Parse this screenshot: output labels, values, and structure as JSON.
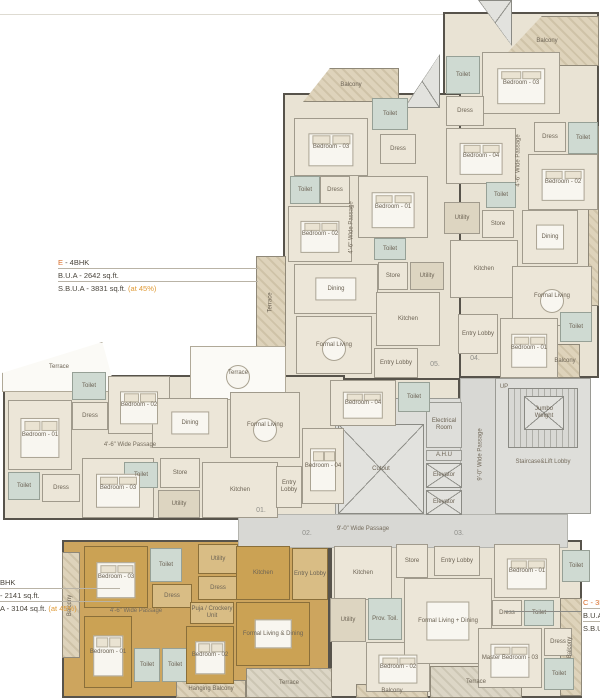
{
  "palette": {
    "unit_fill": "#e9e3d4",
    "highlight_unit_fill": "#cda55e",
    "toilet_fill": "#cfdad2",
    "passage_fill": "#d8d8d4",
    "wall": "#57534b",
    "annotation_accent": "#d96e2a",
    "annotation_highlight": "#e09a35"
  },
  "annotations": {
    "e": {
      "code": "E ",
      "type": "- 4BHK",
      "bua": "B.U.A - 2642 sq.ft.",
      "sbua": "S.B.U.A - 3831 sq.ft.",
      "at": "(at 45%)"
    },
    "a": {
      "type": "BHK",
      "bua": "- 2141 sq.ft.",
      "sbua": "A - 3104 sq.ft.",
      "at": "(at 45%)"
    },
    "c": {
      "code": "C - 3B",
      "bua": "B.U.A - ",
      "sbua": "S.B.U.A"
    }
  },
  "entry_numbers": [
    "01.",
    "02.",
    "03.",
    "04.",
    "05."
  ],
  "rooms": [
    {
      "t": "u-beige",
      "nm": "unit-d-outline",
      "x": 443,
      "y": 12,
      "w": 156,
      "h": 366
    },
    {
      "t": "u-beige",
      "nm": "unit-e-outline",
      "x": 283,
      "y": 93,
      "w": 178,
      "h": 288
    },
    {
      "t": "u-beige",
      "nm": "unit-e-extension",
      "x": 328,
      "y": 378,
      "w": 132,
      "h": 48
    },
    {
      "t": "u-beige",
      "nm": "unit-01-outline",
      "x": 3,
      "y": 375,
      "w": 342,
      "h": 145
    },
    {
      "t": "u-orange",
      "nm": "unit-a-outline",
      "x": 62,
      "y": 540,
      "w": 268,
      "h": 158
    },
    {
      "t": "u-beige",
      "nm": "unit-c-outline",
      "x": 330,
      "y": 540,
      "w": 252,
      "h": 158
    },
    {
      "t": "core",
      "nm": "core-block",
      "x": 335,
      "y": 398,
      "w": 130,
      "h": 118
    },
    {
      "t": "pas",
      "nm": "vertical-passage",
      "x": 460,
      "y": 378,
      "w": 42,
      "h": 138
    },
    {
      "t": "pas",
      "nm": "horizontal-passage",
      "x": 238,
      "y": 514,
      "w": 330,
      "h": 34
    },
    {
      "t": "core",
      "nm": "staircase-block",
      "x": 495,
      "y": 378,
      "w": 96,
      "h": 136
    },
    {
      "t": "xbox",
      "nm": "corner-brace",
      "x": 478,
      "y": 0,
      "w": 34,
      "h": 46,
      "c": "polygon(0 0,100% 0,100% 100%)"
    },
    {
      "t": "bal",
      "l": "Balcony",
      "x": 495,
      "y": 16,
      "w": 104,
      "h": 50,
      "c": "polygon(0 100%,45% 0,100% 0,100% 100%)"
    },
    {
      "t": "bal",
      "l": "Balcony",
      "x": 303,
      "y": 68,
      "w": 96,
      "h": 34,
      "c": "polygon(0 100%,28% 0,100% 0,100% 100%)"
    },
    {
      "t": "xbox",
      "nm": "corner-brace-2",
      "x": 404,
      "y": 54,
      "w": 36,
      "h": 54,
      "c": "polygon(100% 0,100% 100%,0 100%)"
    },
    {
      "t": "bal",
      "l": "Terrace",
      "r": 1,
      "x": 256,
      "y": 256,
      "w": 30,
      "h": 92
    },
    {
      "t": "ter",
      "l": "Terrace",
      "x": 190,
      "y": 346,
      "w": 96,
      "h": 54,
      "f": "round"
    },
    {
      "t": "ter",
      "l": "Terrace",
      "x": 2,
      "y": 342,
      "w": 114,
      "h": 50,
      "c": "polygon(0 62%,88% 0,100% 100%,0 100%)"
    },
    {
      "t": "bal",
      "l": "Balcony",
      "r": 1,
      "x": 62,
      "y": 552,
      "w": 18,
      "h": 106
    },
    {
      "t": "bal",
      "l": "Hanging Balcony",
      "x": 176,
      "y": 680,
      "w": 70,
      "h": 18
    },
    {
      "t": "balg",
      "l": "Terrace",
      "x": 246,
      "y": 668,
      "w": 86,
      "h": 30
    },
    {
      "t": "balg",
      "l": "Terrace",
      "x": 430,
      "y": 666,
      "w": 92,
      "h": 32
    },
    {
      "t": "bal",
      "l": "Balcony",
      "x": 356,
      "y": 684,
      "w": 72,
      "h": 14
    },
    {
      "t": "bal",
      "l": "Balcony",
      "r": 1,
      "x": 560,
      "y": 598,
      "w": 22,
      "h": 98
    },
    {
      "t": "bal",
      "nm": "balcony-strip-right",
      "x": 588,
      "y": 126,
      "w": 11,
      "h": 180
    },
    {
      "t": "bal",
      "l": "Balcony",
      "x": 550,
      "y": 344,
      "w": 30,
      "h": 34
    },
    {
      "t": "core",
      "l": "Electrical Room",
      "x": 426,
      "y": 402,
      "w": 36,
      "h": 46
    },
    {
      "t": "core",
      "l": "A.H.U",
      "x": 426,
      "y": 450,
      "w": 36,
      "h": 11
    },
    {
      "t": "xbox",
      "l": "Elevator",
      "x": 426,
      "y": 463,
      "w": 36,
      "h": 25
    },
    {
      "t": "xbox",
      "l": "Elevator",
      "x": 426,
      "y": 490,
      "w": 36,
      "h": 25
    },
    {
      "t": "xbox",
      "l": "Cutout",
      "x": 338,
      "y": 424,
      "w": 86,
      "h": 90
    },
    {
      "t": "stair",
      "nm": "staircase-treads",
      "x": 508,
      "y": 388,
      "w": 70,
      "h": 60
    },
    {
      "t": "xbox",
      "l": "Jumbo Weight",
      "x": 524,
      "y": 396,
      "w": 40,
      "h": 34
    },
    {
      "t": "pl",
      "l": "UP",
      "x": 496,
      "y": 382,
      "w": 16,
      "h": 10
    },
    {
      "t": "pl",
      "l": "Staircase&Lift Lobby",
      "x": 497,
      "y": 456,
      "w": 92,
      "h": 12
    },
    {
      "t": "toi",
      "l": "Toilet",
      "x": 446,
      "y": 56,
      "w": 34,
      "h": 38
    },
    {
      "t": "room",
      "l": "Bedroom - 03",
      "x": 482,
      "y": 52,
      "w": 78,
      "h": 62,
      "f": "bed"
    },
    {
      "t": "room",
      "l": "Dress",
      "x": 446,
      "y": 96,
      "w": 38,
      "h": 30
    },
    {
      "t": "room",
      "l": "Bedroom - 04",
      "x": 446,
      "y": 128,
      "w": 70,
      "h": 56,
      "f": "bed"
    },
    {
      "t": "room",
      "l": "Dress",
      "x": 534,
      "y": 122,
      "w": 32,
      "h": 30
    },
    {
      "t": "toi",
      "l": "Toilet",
      "x": 568,
      "y": 122,
      "w": 30,
      "h": 32
    },
    {
      "t": "room",
      "l": "Bedroom - 02",
      "x": 528,
      "y": 154,
      "w": 70,
      "h": 56,
      "f": "bed"
    },
    {
      "t": "toi",
      "l": "Toilet",
      "x": 486,
      "y": 182,
      "w": 30,
      "h": 26
    },
    {
      "t": "dark",
      "l": "Utility",
      "x": 444,
      "y": 202,
      "w": 36,
      "h": 32
    },
    {
      "t": "room",
      "l": "Store",
      "x": 482,
      "y": 210,
      "w": 32,
      "h": 28
    },
    {
      "t": "room",
      "l": "Kitchen",
      "x": 450,
      "y": 240,
      "w": 68,
      "h": 58
    },
    {
      "t": "room",
      "l": "Dining",
      "x": 522,
      "y": 210,
      "w": 56,
      "h": 54,
      "f": "table"
    },
    {
      "t": "room",
      "l": "Formal Living",
      "x": 512,
      "y": 266,
      "w": 80,
      "h": 60,
      "f": "round"
    },
    {
      "t": "room",
      "l": "Entry Lobby",
      "x": 458,
      "y": 314,
      "w": 40,
      "h": 40
    },
    {
      "t": "room",
      "l": "Bedroom - 01",
      "x": 500,
      "y": 318,
      "w": 58,
      "h": 60,
      "f": "bed"
    },
    {
      "t": "toi",
      "l": "Toilet",
      "x": 560,
      "y": 312,
      "w": 32,
      "h": 30
    },
    {
      "t": "pl",
      "l": "4'-6\" Wide Passage",
      "r": 1,
      "x": 512,
      "y": 128,
      "w": 14,
      "h": 64
    },
    {
      "t": "room",
      "l": "Bedroom - 03",
      "x": 294,
      "y": 118,
      "w": 74,
      "h": 58,
      "f": "bed"
    },
    {
      "t": "toi",
      "l": "Toilet",
      "x": 372,
      "y": 98,
      "w": 36,
      "h": 32
    },
    {
      "t": "room",
      "l": "Dress",
      "x": 380,
      "y": 134,
      "w": 36,
      "h": 30
    },
    {
      "t": "room",
      "l": "Bedroom - 01",
      "x": 358,
      "y": 176,
      "w": 70,
      "h": 62,
      "f": "bed"
    },
    {
      "t": "toi",
      "l": "Toilet",
      "x": 290,
      "y": 176,
      "w": 30,
      "h": 28
    },
    {
      "t": "room",
      "l": "Dress",
      "x": 320,
      "y": 176,
      "w": 30,
      "h": 28
    },
    {
      "t": "room",
      "l": "Bedroom - 02",
      "x": 288,
      "y": 206,
      "w": 64,
      "h": 56,
      "f": "bed"
    },
    {
      "t": "toi",
      "l": "Toilet",
      "x": 374,
      "y": 238,
      "w": 32,
      "h": 22
    },
    {
      "t": "room",
      "l": "Dining",
      "x": 294,
      "y": 264,
      "w": 84,
      "h": 50,
      "f": "table"
    },
    {
      "t": "room",
      "l": "Store",
      "x": 378,
      "y": 262,
      "w": 30,
      "h": 28
    },
    {
      "t": "dark",
      "l": "Utility",
      "x": 410,
      "y": 262,
      "w": 34,
      "h": 28
    },
    {
      "t": "room",
      "l": "Kitchen",
      "x": 376,
      "y": 292,
      "w": 64,
      "h": 54
    },
    {
      "t": "room",
      "l": "Formal Living",
      "x": 296,
      "y": 316,
      "w": 76,
      "h": 58,
      "f": "round"
    },
    {
      "t": "room",
      "l": "Entry Lobby",
      "x": 374,
      "y": 348,
      "w": 44,
      "h": 30
    },
    {
      "t": "room",
      "l": "Bedroom - 04",
      "x": 330,
      "y": 380,
      "w": 66,
      "h": 46,
      "f": "bed"
    },
    {
      "t": "toi",
      "l": "Toilet",
      "x": 398,
      "y": 382,
      "w": 32,
      "h": 30
    },
    {
      "t": "pl",
      "l": "4'-6\" Wide Passage",
      "r": 1,
      "x": 346,
      "y": 198,
      "w": 12,
      "h": 58
    },
    {
      "t": "toi",
      "l": "Toilet",
      "x": 72,
      "y": 372,
      "w": 34,
      "h": 28
    },
    {
      "t": "room",
      "l": "Bedroom - 02",
      "x": 108,
      "y": 376,
      "w": 62,
      "h": 58,
      "f": "bed"
    },
    {
      "t": "room",
      "l": "Dress",
      "x": 72,
      "y": 402,
      "w": 36,
      "h": 28
    },
    {
      "t": "room",
      "l": "Bedroom - 01",
      "x": 8,
      "y": 400,
      "w": 64,
      "h": 70,
      "f": "bed"
    },
    {
      "t": "toi",
      "l": "Toilet",
      "x": 8,
      "y": 472,
      "w": 32,
      "h": 28
    },
    {
      "t": "room",
      "l": "Dress",
      "x": 42,
      "y": 474,
      "w": 38,
      "h": 28
    },
    {
      "t": "room",
      "l": "Bedroom - 03",
      "x": 82,
      "y": 458,
      "w": 72,
      "h": 60,
      "f": "bed"
    },
    {
      "t": "room",
      "l": "Dining",
      "x": 152,
      "y": 398,
      "w": 76,
      "h": 50,
      "f": "table"
    },
    {
      "t": "room",
      "l": "Formal Living",
      "x": 230,
      "y": 392,
      "w": 70,
      "h": 66,
      "f": "round"
    },
    {
      "t": "toi",
      "l": "Toilet",
      "x": 124,
      "y": 462,
      "w": 34,
      "h": 26
    },
    {
      "t": "room",
      "l": "Store",
      "x": 160,
      "y": 458,
      "w": 40,
      "h": 30
    },
    {
      "t": "dark",
      "l": "Utility",
      "x": 158,
      "y": 490,
      "w": 42,
      "h": 28
    },
    {
      "t": "room",
      "l": "Kitchen",
      "x": 202,
      "y": 462,
      "w": 76,
      "h": 56
    },
    {
      "t": "room",
      "l": "Entry Lobby",
      "x": 276,
      "y": 466,
      "w": 26,
      "h": 42
    },
    {
      "t": "room",
      "l": "Bedroom - 04",
      "x": 302,
      "y": 428,
      "w": 42,
      "h": 76,
      "f": "bed"
    },
    {
      "t": "pl",
      "l": "4'-6\" Wide Passage",
      "x": 62,
      "y": 438,
      "w": 136,
      "h": 14
    },
    {
      "t": "orange",
      "l": "Bedroom - 03",
      "x": 84,
      "y": 546,
      "w": 64,
      "h": 62,
      "f": "bed"
    },
    {
      "t": "toi",
      "l": "Toilet",
      "x": 150,
      "y": 548,
      "w": 32,
      "h": 34
    },
    {
      "t": "oli",
      "l": "Dress",
      "x": 152,
      "y": 584,
      "w": 40,
      "h": 24
    },
    {
      "t": "oli",
      "l": "Utility",
      "x": 198,
      "y": 544,
      "w": 40,
      "h": 30
    },
    {
      "t": "oli",
      "l": "Dress",
      "x": 198,
      "y": 576,
      "w": 40,
      "h": 24
    },
    {
      "t": "oli",
      "l": "Puja / Crockery Unit",
      "x": 190,
      "y": 602,
      "w": 44,
      "h": 22
    },
    {
      "t": "orange",
      "l": "Bedroom - 01",
      "x": 84,
      "y": 616,
      "w": 48,
      "h": 72,
      "f": "bed"
    },
    {
      "t": "toi",
      "l": "Toilet",
      "x": 134,
      "y": 648,
      "w": 26,
      "h": 34
    },
    {
      "t": "toi",
      "l": "Toilet",
      "x": 162,
      "y": 648,
      "w": 26,
      "h": 34
    },
    {
      "t": "orange",
      "l": "Bedroom - 02",
      "x": 186,
      "y": 626,
      "w": 48,
      "h": 58,
      "f": "bed"
    },
    {
      "t": "orange",
      "l": "Kitchen",
      "x": 236,
      "y": 546,
      "w": 54,
      "h": 54
    },
    {
      "t": "oli",
      "l": "Entry Lobby",
      "x": 292,
      "y": 548,
      "w": 36,
      "h": 52
    },
    {
      "t": "orange",
      "l": "Formal Living & Dining",
      "x": 236,
      "y": 602,
      "w": 74,
      "h": 64,
      "f": "table"
    },
    {
      "t": "pl",
      "l": "4'-6\" Wide Passage",
      "x": 86,
      "y": 606,
      "w": 100,
      "h": 10
    },
    {
      "t": "room",
      "l": "Kitchen",
      "x": 334,
      "y": 546,
      "w": 58,
      "h": 54
    },
    {
      "t": "room",
      "l": "Store",
      "x": 396,
      "y": 544,
      "w": 32,
      "h": 34
    },
    {
      "t": "dark",
      "l": "Utility",
      "x": 330,
      "y": 598,
      "w": 36,
      "h": 44
    },
    {
      "t": "toi",
      "l": "Prov. Toil.",
      "x": 368,
      "y": 598,
      "w": 34,
      "h": 42
    },
    {
      "t": "room",
      "l": "Bedroom - 02",
      "x": 366,
      "y": 642,
      "w": 64,
      "h": 50,
      "f": "bed"
    },
    {
      "t": "room",
      "l": "Entry Lobby",
      "x": 434,
      "y": 546,
      "w": 46,
      "h": 30
    },
    {
      "t": "room",
      "l": "Formal Living + Dining",
      "x": 404,
      "y": 578,
      "w": 88,
      "h": 86,
      "f": "table"
    },
    {
      "t": "room",
      "l": "Bedroom - 01",
      "x": 494,
      "y": 544,
      "w": 66,
      "h": 54,
      "f": "bed"
    },
    {
      "t": "room",
      "l": "Dress",
      "x": 492,
      "y": 600,
      "w": 30,
      "h": 26
    },
    {
      "t": "toi",
      "l": "Toilet",
      "x": 524,
      "y": 600,
      "w": 30,
      "h": 26
    },
    {
      "t": "room",
      "l": "Master Bedroom - 03",
      "x": 478,
      "y": 628,
      "w": 64,
      "h": 60,
      "f": "bed"
    },
    {
      "t": "room",
      "l": "Dress",
      "x": 544,
      "y": 628,
      "w": 28,
      "h": 28
    },
    {
      "t": "toi",
      "l": "Toilet",
      "x": 544,
      "y": 658,
      "w": 30,
      "h": 32
    },
    {
      "t": "toi",
      "l": "Toilet",
      "x": 562,
      "y": 550,
      "w": 28,
      "h": 32
    },
    {
      "t": "pl",
      "l": "9'-0\" Wide Passage",
      "x": 308,
      "y": 521,
      "w": 110,
      "h": 16
    },
    {
      "t": "pl",
      "l": "9'-0\" Wide Passage",
      "r": 1,
      "x": 464,
      "y": 418,
      "w": 34,
      "h": 72
    },
    {
      "t": "num",
      "l": "01.",
      "x": 250,
      "y": 506,
      "w": 22,
      "h": 10
    },
    {
      "t": "num",
      "l": "02.",
      "x": 296,
      "y": 529,
      "w": 22,
      "h": 10
    },
    {
      "t": "num",
      "l": "03.",
      "x": 448,
      "y": 529,
      "w": 22,
      "h": 10
    },
    {
      "t": "num",
      "l": "04.",
      "x": 464,
      "y": 354,
      "w": 22,
      "h": 10
    },
    {
      "t": "num",
      "l": "05.",
      "x": 424,
      "y": 360,
      "w": 22,
      "h": 10
    }
  ]
}
